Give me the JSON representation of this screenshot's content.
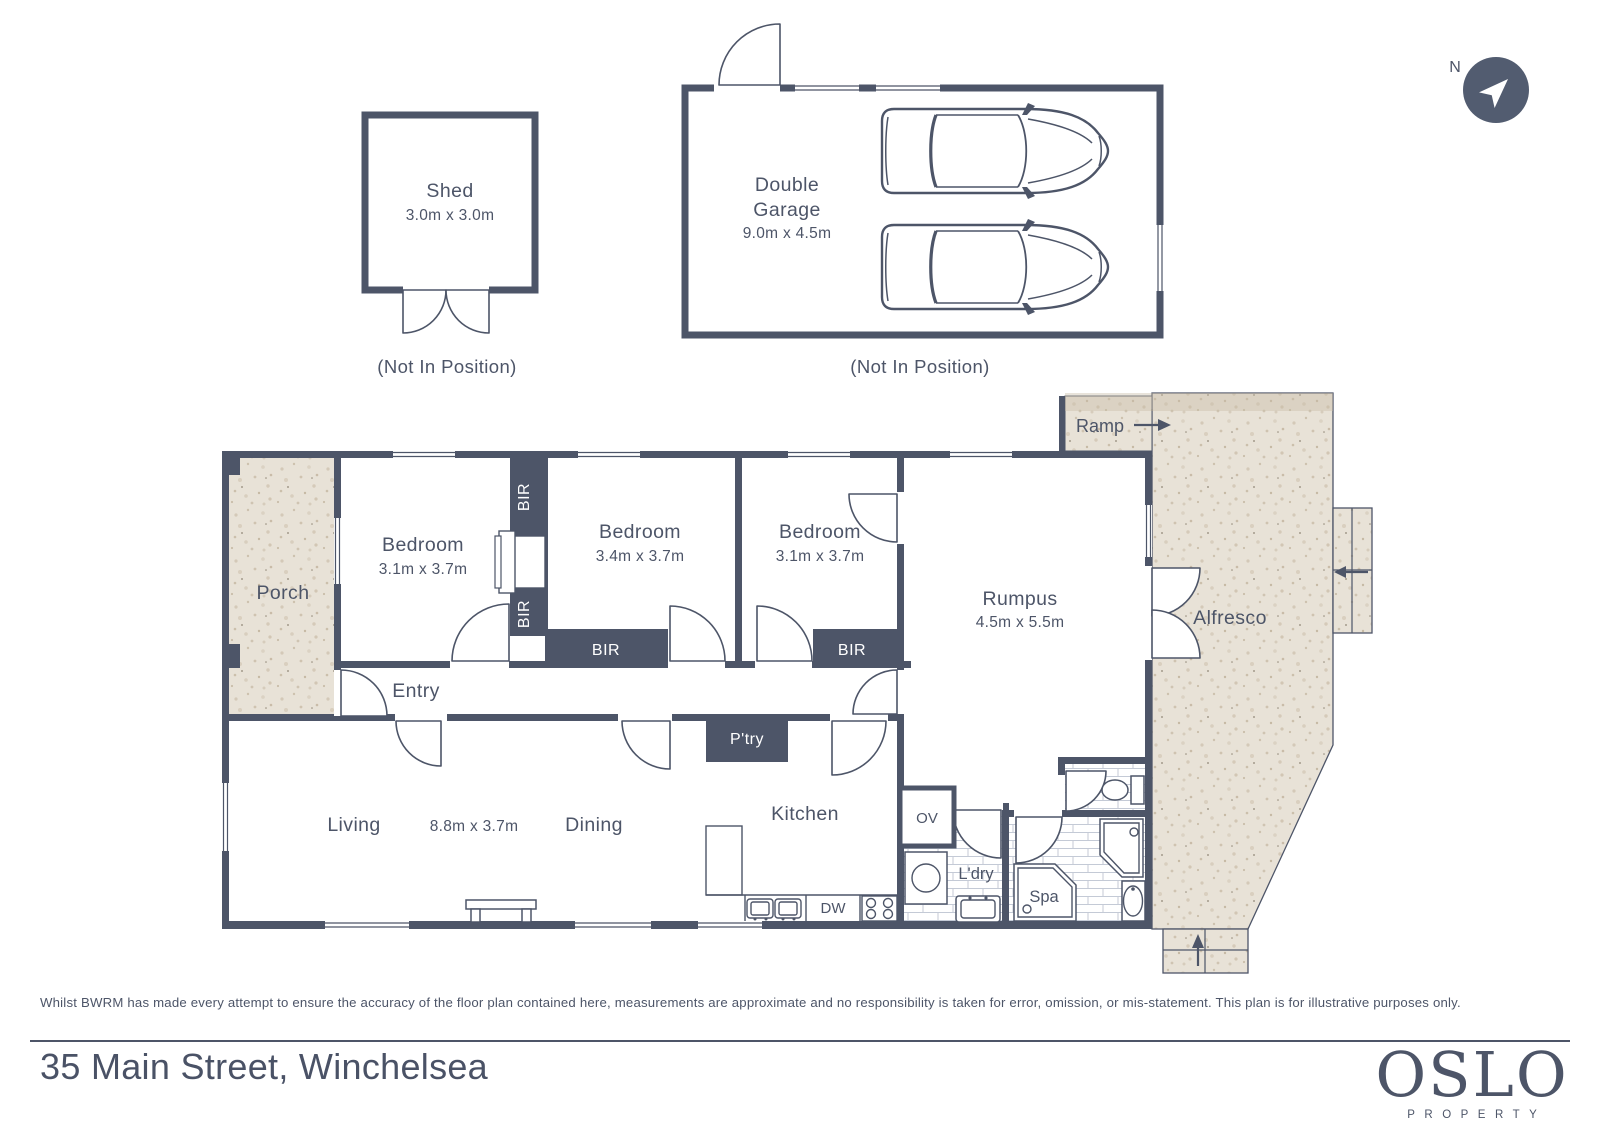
{
  "compass": {
    "north": "N"
  },
  "outbuildings": {
    "shed": {
      "name": "Shed",
      "dims": "3.0m x 3.0m",
      "note": "(Not In Position)"
    },
    "garage": {
      "name1": "Double",
      "name2": "Garage",
      "dims": "9.0m x 4.5m",
      "note": "(Not In Position)"
    }
  },
  "rooms": {
    "porch": "Porch",
    "bedroom1": {
      "name": "Bedroom",
      "dims": "3.1m x 3.7m"
    },
    "bedroom2": {
      "name": "Bedroom",
      "dims": "3.4m x 3.7m"
    },
    "bedroom3": {
      "name": "Bedroom",
      "dims": "3.1m x 3.7m"
    },
    "entry": "Entry",
    "rumpus": {
      "name": "Rumpus",
      "dims": "4.5m x 5.5m"
    },
    "living": "Living",
    "living_dining_dims": "8.8m x 3.7m",
    "dining": "Dining",
    "kitchen": "Kitchen",
    "pantry": "P'try",
    "oven": "OV",
    "dishwasher": "DW",
    "laundry": "L'dry",
    "spa": "Spa",
    "ramp": "Ramp",
    "alfresco": "Alfresco",
    "bir": "BIR"
  },
  "footer": {
    "disclaimer": "Whilst BWRM  has made every attempt to ensure the accuracy of the floor plan contained here, measurements are approximate and no responsibility is taken for error, omission, or mis-statement. This plan is for illustrative purposes only.",
    "address": "35 Main Street, Winchelsea"
  },
  "logo": {
    "name": "OSLO",
    "tagline": "PROPERTY"
  },
  "colors": {
    "wall": "#4d5568",
    "text": "#4d5568",
    "concrete": "#e8e2d7",
    "tile_line": "#c4cad6"
  }
}
